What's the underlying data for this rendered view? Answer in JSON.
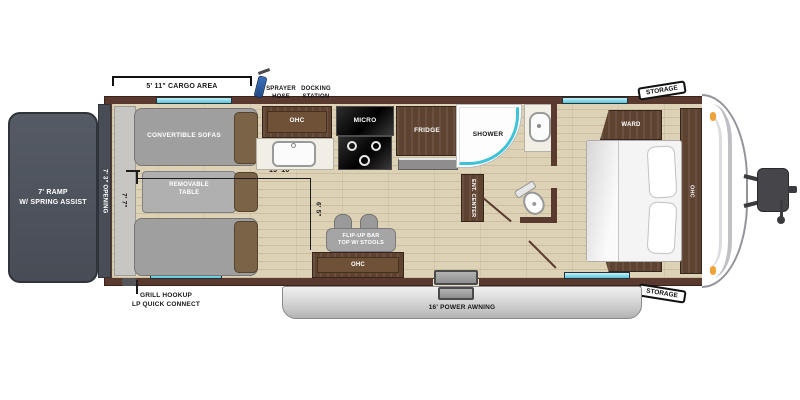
{
  "plan": {
    "type": "rv-travel-trailer-floor-plan",
    "exterior": {
      "ramp": "7' RAMP\nW/ SPRING ASSIST",
      "opening": "7' 3\" OPENING",
      "cargo_area": "5' 11\" CARGO AREA",
      "sprayer_hose": "SPRAYER\nHOSE",
      "docking_station": "DOCKING\nSTATION",
      "grill_hookup": "GRILL HOOKUP\nLP QUICK CONNECT",
      "power_awning": "16' POWER AWNING",
      "storage_top": "STORAGE",
      "storage_bottom": "STORAGE"
    },
    "garage": {
      "convertible_sofas": "CONVERTIBLE SOFAS",
      "removable_table": "REMOVABLE\nTABLE",
      "width_dim": "7' 7\"",
      "length_dim": "13' 10\"",
      "mid_dim": "6' 5\""
    },
    "kitchen": {
      "ohc_top": "OHC",
      "micro": "MICRO",
      "fridge": "FRIDGE",
      "flip_up_bar": "FLIP-UP BAR\nTOP W/ STOOLS",
      "ohc_bottom": "OHC"
    },
    "bath": {
      "shower": "SHOWER"
    },
    "living": {
      "ent_center": "ENT. CENTER"
    },
    "bedroom": {
      "ward_top": "WARD",
      "ward_bottom": "WARD",
      "ohc": "OHC"
    },
    "colors": {
      "wall": "#5a392f",
      "floor": "#ddd2b6",
      "wood": "#5e4331",
      "ramp": "#474c55",
      "window_teal": "#58c6db",
      "shower_teal": "#3fc3d6",
      "marker_orange": "#f0a23a",
      "awning_gray": "#c9c9c9"
    }
  }
}
